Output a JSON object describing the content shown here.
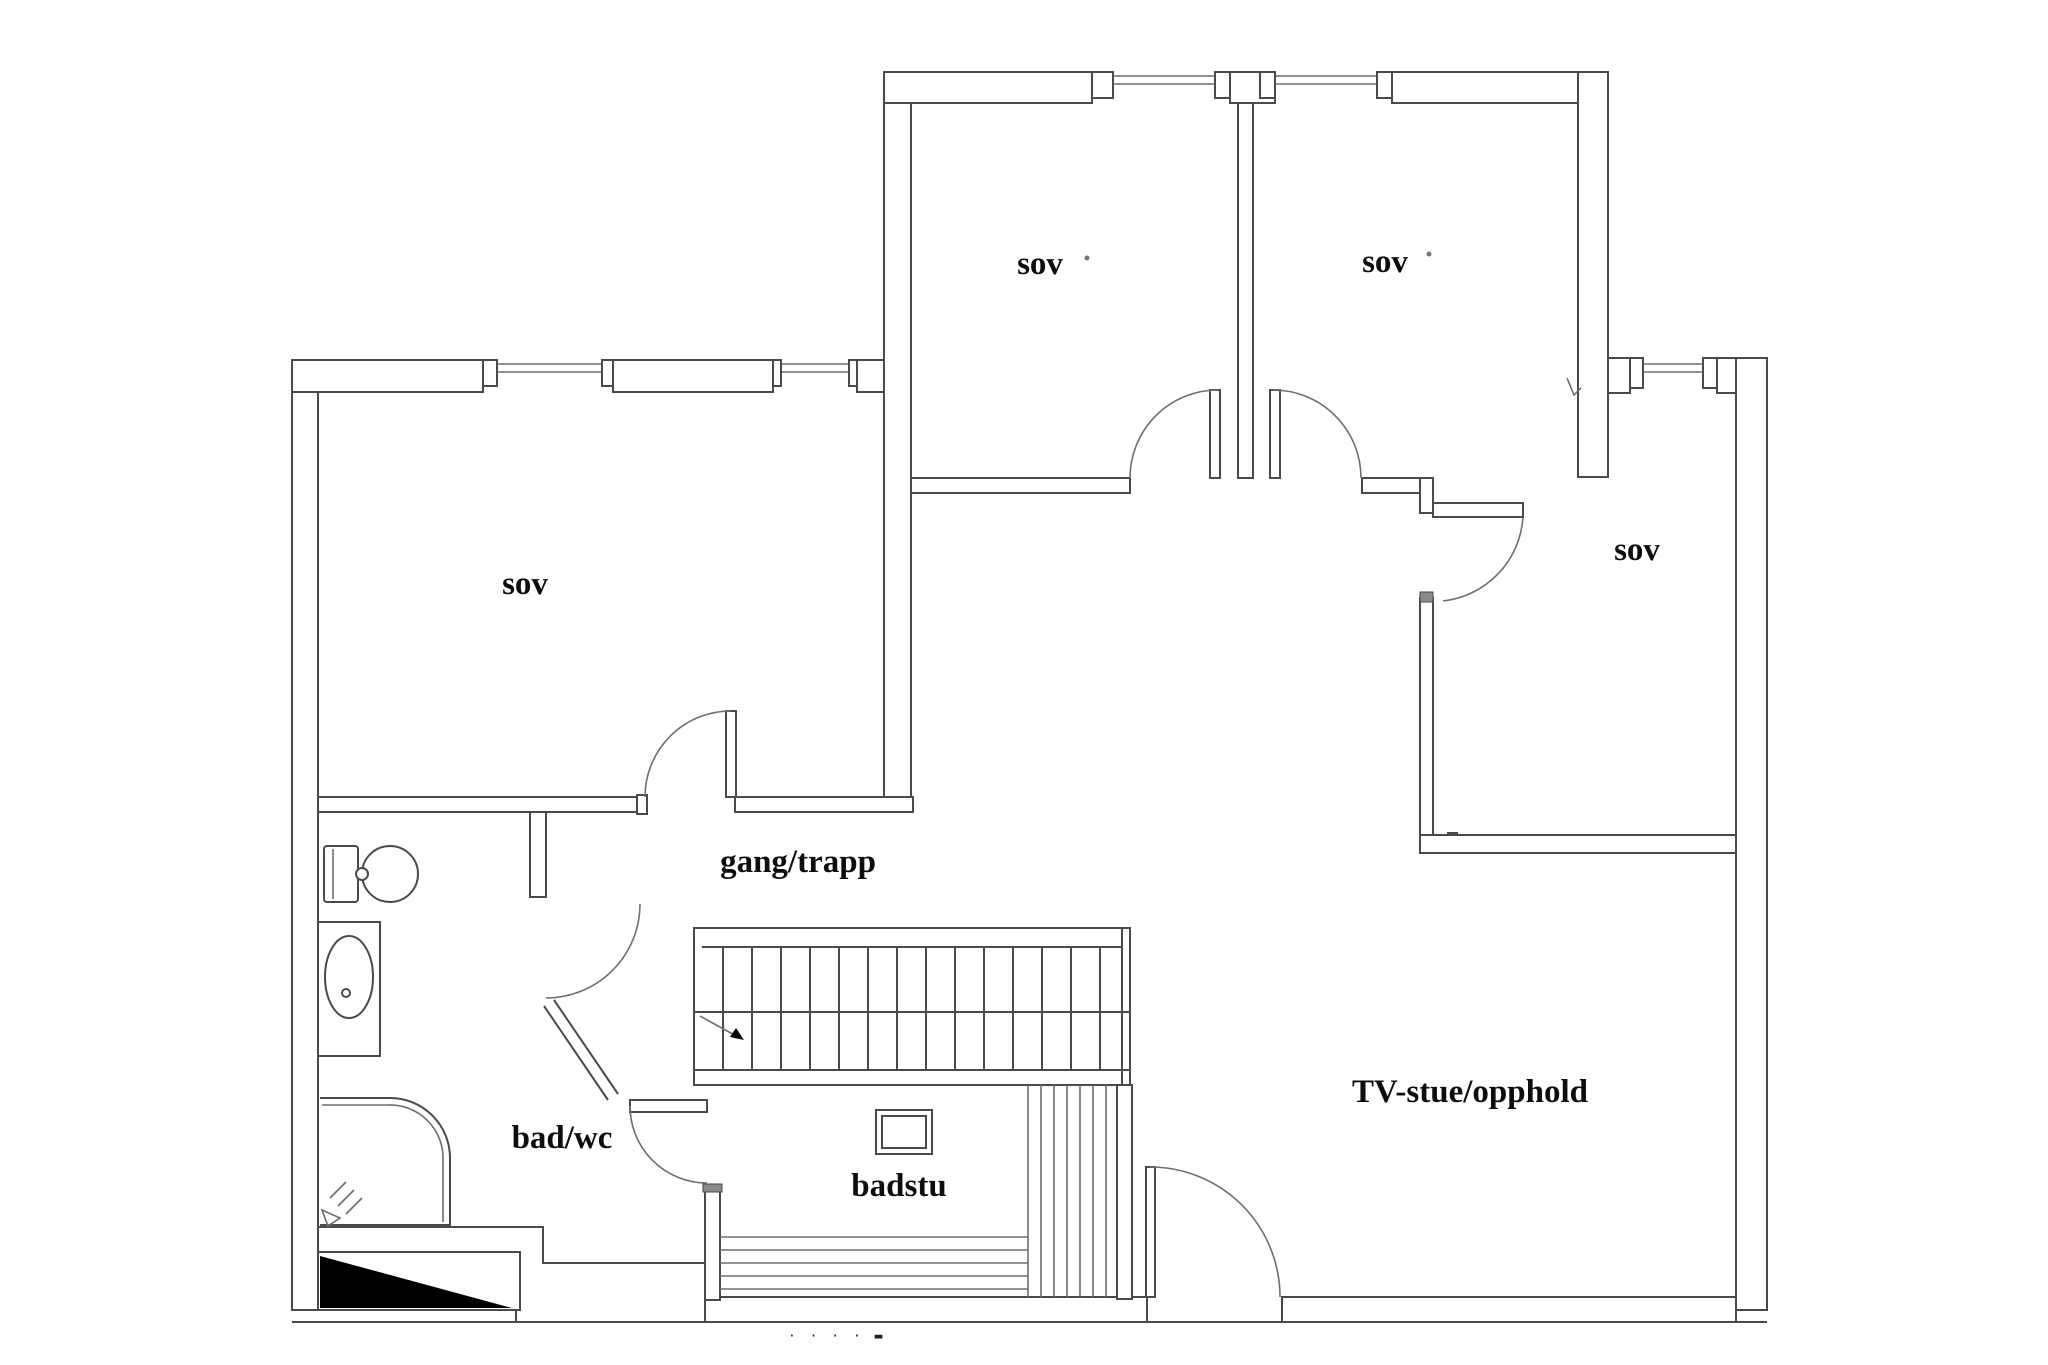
{
  "meta": {
    "type": "floor-plan",
    "style": "architectural line drawing"
  },
  "colors": {
    "line": "#4a4a4a",
    "thin": "#6e6e6e",
    "label": "#0d0d0d",
    "solid": "#000000",
    "paper": "#ffffff"
  },
  "rooms": {
    "sov_left": {
      "label": "sov"
    },
    "sov_top_middle": {
      "label": "sov"
    },
    "sov_top_right": {
      "label": "sov"
    },
    "sov_right": {
      "label": "sov"
    },
    "gang_trapp": {
      "label": "gang/trapp"
    },
    "bad_wc": {
      "label": "bad/wc"
    },
    "badstu": {
      "label": "badstu"
    },
    "tv_stue": {
      "label": "TV-stue/opphold"
    }
  },
  "fixtures": {
    "toilet": "toilet",
    "sink": "sink-basin",
    "shower": "shower-cabin",
    "sauna_stove": "sauna-stove",
    "sauna_benches": "sauna-benches",
    "stairs": "staircase-with-up-arrow"
  },
  "caption": {
    "clipped": "· ·      · · ▬"
  }
}
